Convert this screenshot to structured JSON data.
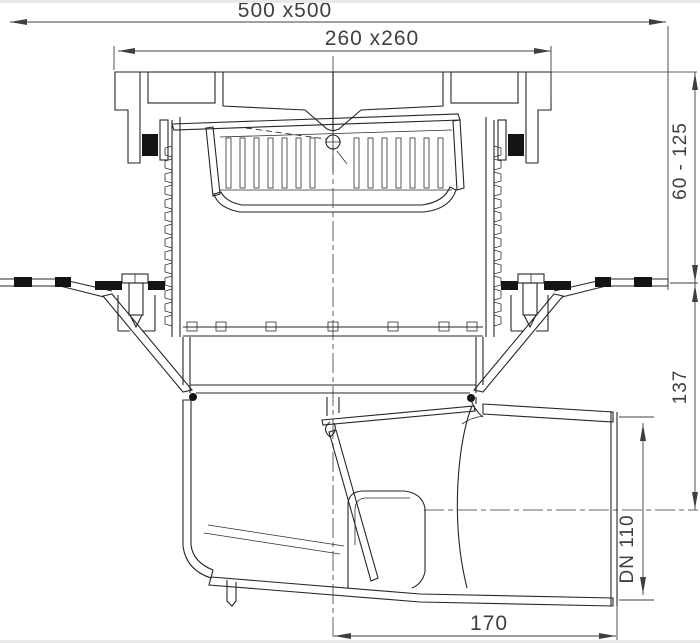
{
  "drawing": {
    "labels": {
      "overall": "500 x500",
      "grate": "260 x260",
      "height_range": "60 - 125",
      "depth_to_outlet_axis": "137",
      "outlet_diameter": "DN 110",
      "outlet_offset": "170"
    },
    "colors": {
      "line": "#262626",
      "dimension": "#3f3f3f",
      "background": "#ffffff",
      "seal": "#141414",
      "page_edge": "#e9e9e9"
    }
  }
}
